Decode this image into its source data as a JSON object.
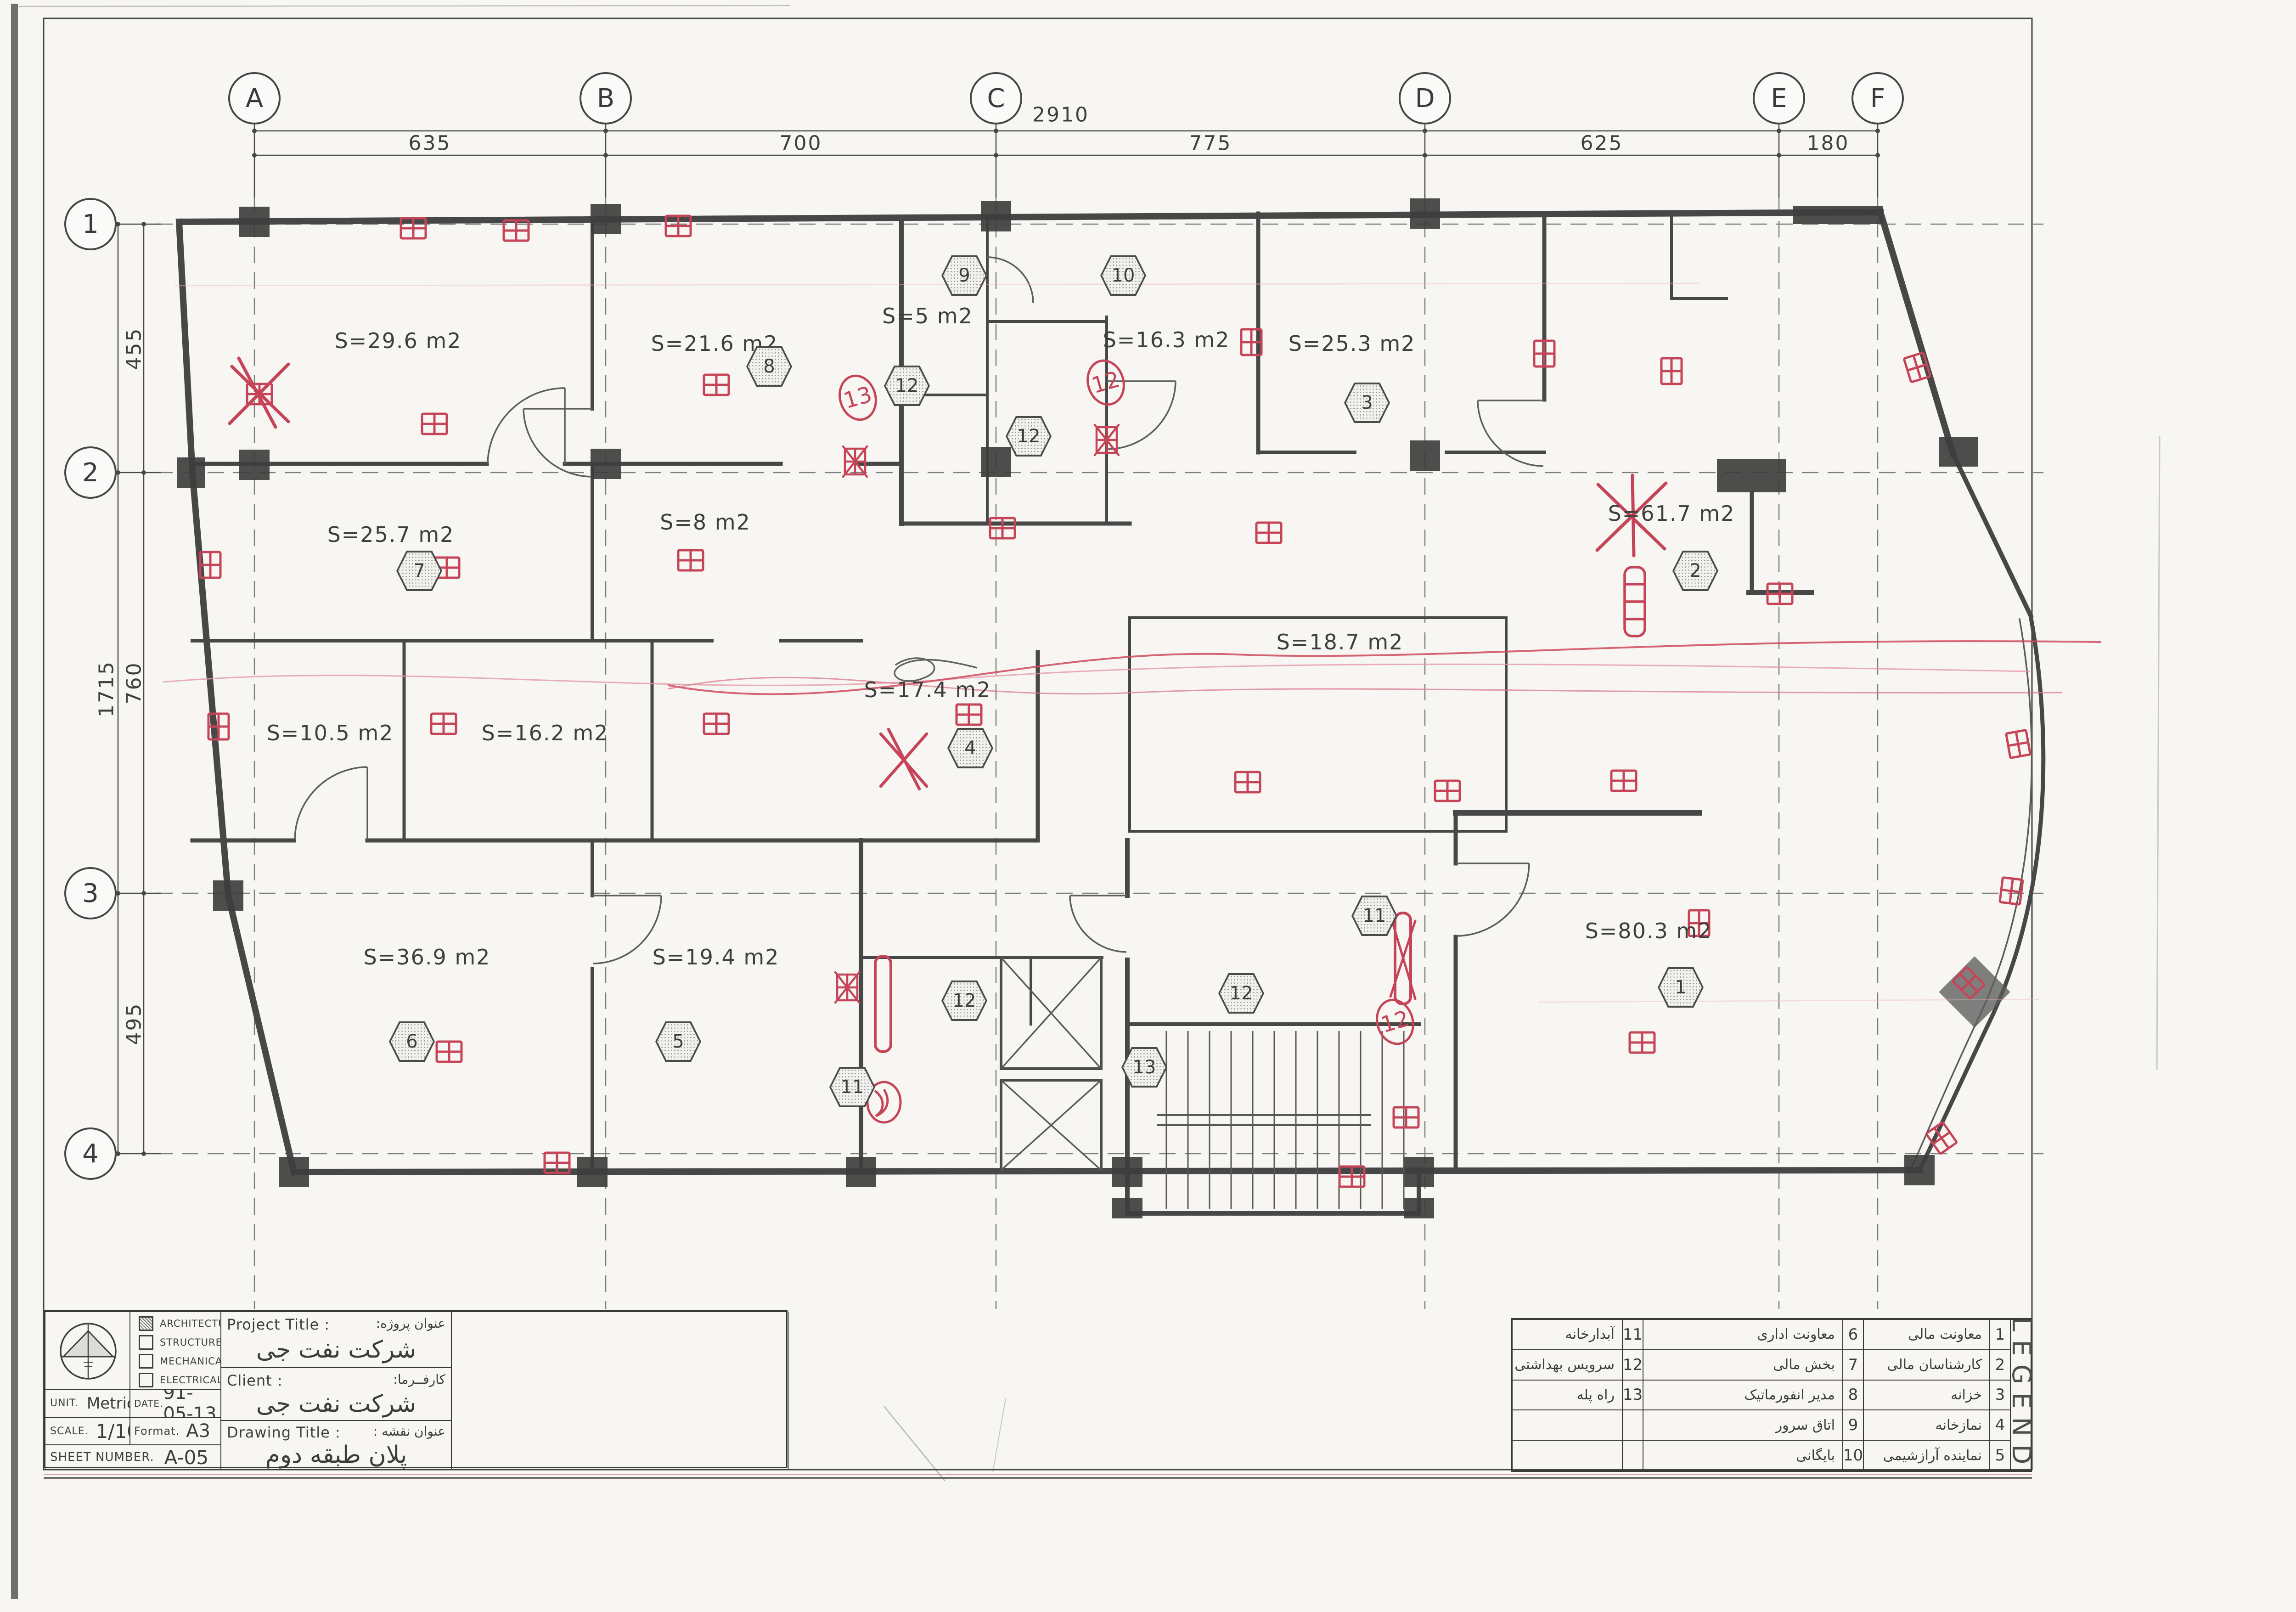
{
  "title_block": {
    "project_title_label": "Project Title :",
    "project_title_fa_label": "عنوان پروژه:",
    "project_title_value": "شرکت نفت جی",
    "client_label": "Client :",
    "client_fa_label": "کارفــرما:",
    "client_value": "شرکت نفت جی",
    "drawing_title_label": "Drawing Title :",
    "drawing_title_fa_label": "عنوان نقشه :",
    "drawing_title_value": "پلان طبقه دوم",
    "unit_label": "UNIT.",
    "unit_value": "Metric",
    "date_label": "DATE.",
    "date_value": "91-05-13",
    "scale_label": "SCALE.",
    "scale_value": "1/100",
    "format_label": "Format.",
    "format_value": "A3",
    "sheet_number_label": "SHEET NUMBER.",
    "sheet_number_value": "A-05",
    "disciplines": [
      {
        "label": "ARCHITECTURE",
        "checked": true
      },
      {
        "label": "STRUCTURE",
        "checked": false
      },
      {
        "label": "MECHANICAL",
        "checked": false
      },
      {
        "label": "ELECTRICAL",
        "checked": false
      }
    ]
  },
  "legend": {
    "title": "LEGEND",
    "entries": [
      {
        "no": "1",
        "name": "معاونت مالی"
      },
      {
        "no": "2",
        "name": "کارشناسان مالی"
      },
      {
        "no": "3",
        "name": "خزانه"
      },
      {
        "no": "4",
        "name": "نمازخانه"
      },
      {
        "no": "5",
        "name": "نماینده آرازشیمی"
      },
      {
        "no": "6",
        "name": "معاونت اداری"
      },
      {
        "no": "7",
        "name": "بخش مالی"
      },
      {
        "no": "8",
        "name": "مدیر انفورماتیک"
      },
      {
        "no": "9",
        "name": "اتاق سرور"
      },
      {
        "no": "10",
        "name": "بایگانی"
      },
      {
        "no": "11",
        "name": "آبدارخانه"
      },
      {
        "no": "12",
        "name": "سرویس بهداشتی"
      },
      {
        "no": "13",
        "name": "راه پله"
      }
    ]
  },
  "grid": {
    "columns": [
      "A",
      "B",
      "C",
      "D",
      "E",
      "F"
    ],
    "col_dims": [
      "635",
      "700",
      "775",
      "625",
      "180"
    ],
    "overall_width": "2910",
    "rows": [
      "1",
      "2",
      "3",
      "4"
    ],
    "row_dims": [
      "455",
      "760",
      "495"
    ],
    "overall_height": "1715"
  },
  "rooms": [
    "S=29.6 m2",
    "S=21.6 m2",
    "S=5 m2",
    "S=16.3 m2",
    "S=25.3 m2",
    "S=25.7 m2",
    "S=8 m2",
    "S=61.7 m2",
    "S=18.7 m2",
    "S=17.4 m2",
    "S=10.5 m2",
    "S=16.2 m2",
    "S=36.9 m2",
    "S=19.4 m2",
    "S=80.3 m2"
  ],
  "hexes": [
    "9",
    "10",
    "8",
    "12",
    "12",
    "3",
    "7",
    "2",
    "4",
    "6",
    "5",
    "11",
    "12",
    "13",
    "12",
    "11",
    "1"
  ],
  "annotations": {
    "red_circled": [
      "13",
      "12",
      "12"
    ]
  },
  "colors": {
    "annotation_red": "#c64458",
    "line_dark": "#454545"
  }
}
